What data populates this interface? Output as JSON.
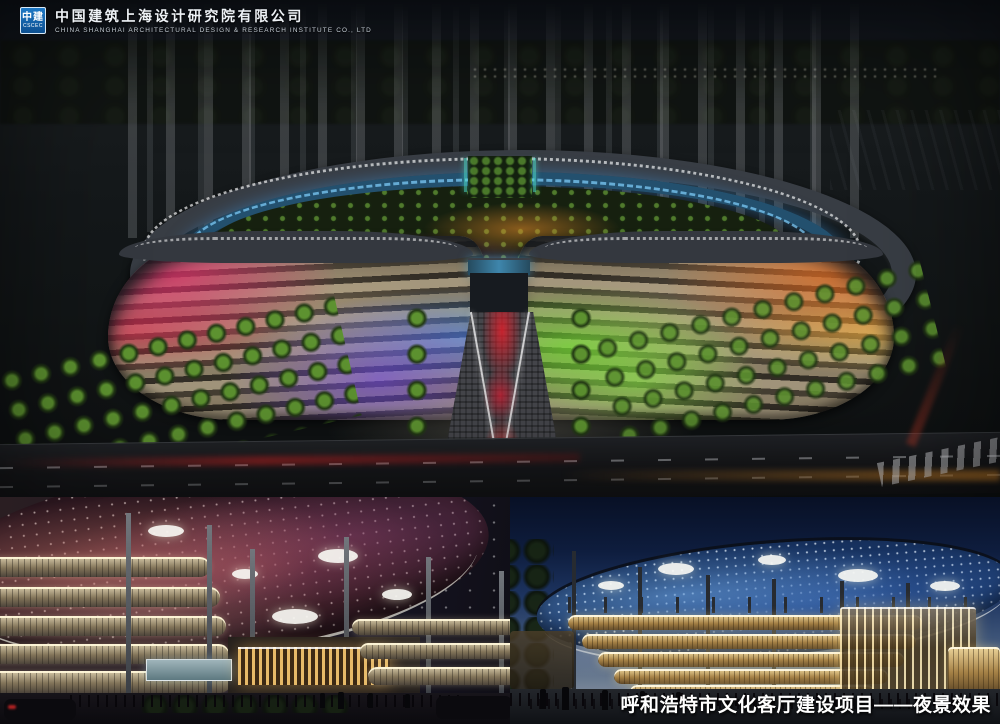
{
  "logo": {
    "mark_line1": "中建",
    "mark_line2": "CSCEC",
    "company_zh": "中国建筑上海设计研究院有限公司",
    "company_en": "CHINA SHANGHAI ARCHITECTURAL DESIGN & RESEARCH INSTITUTE CO., LTD"
  },
  "caption": {
    "project_zh": "呼和浩特市文化客厅建设项目——夜景效果"
  },
  "colors": {
    "logo_blue": "#1464a8",
    "glass_ring_blue": "#2e6e9e",
    "facade_magenta": "#e03a8c",
    "facade_purple": "#7a4ae0",
    "facade_green": "#76d22c",
    "facade_orange": "#f0a030",
    "walkway_red": "#cc2630",
    "nebula_canopy_red": "#8a4a5c",
    "dome_canopy_blue": "#2c55a0",
    "facade_band_gold": "#d8b878",
    "caption_white": "#ffffff"
  }
}
